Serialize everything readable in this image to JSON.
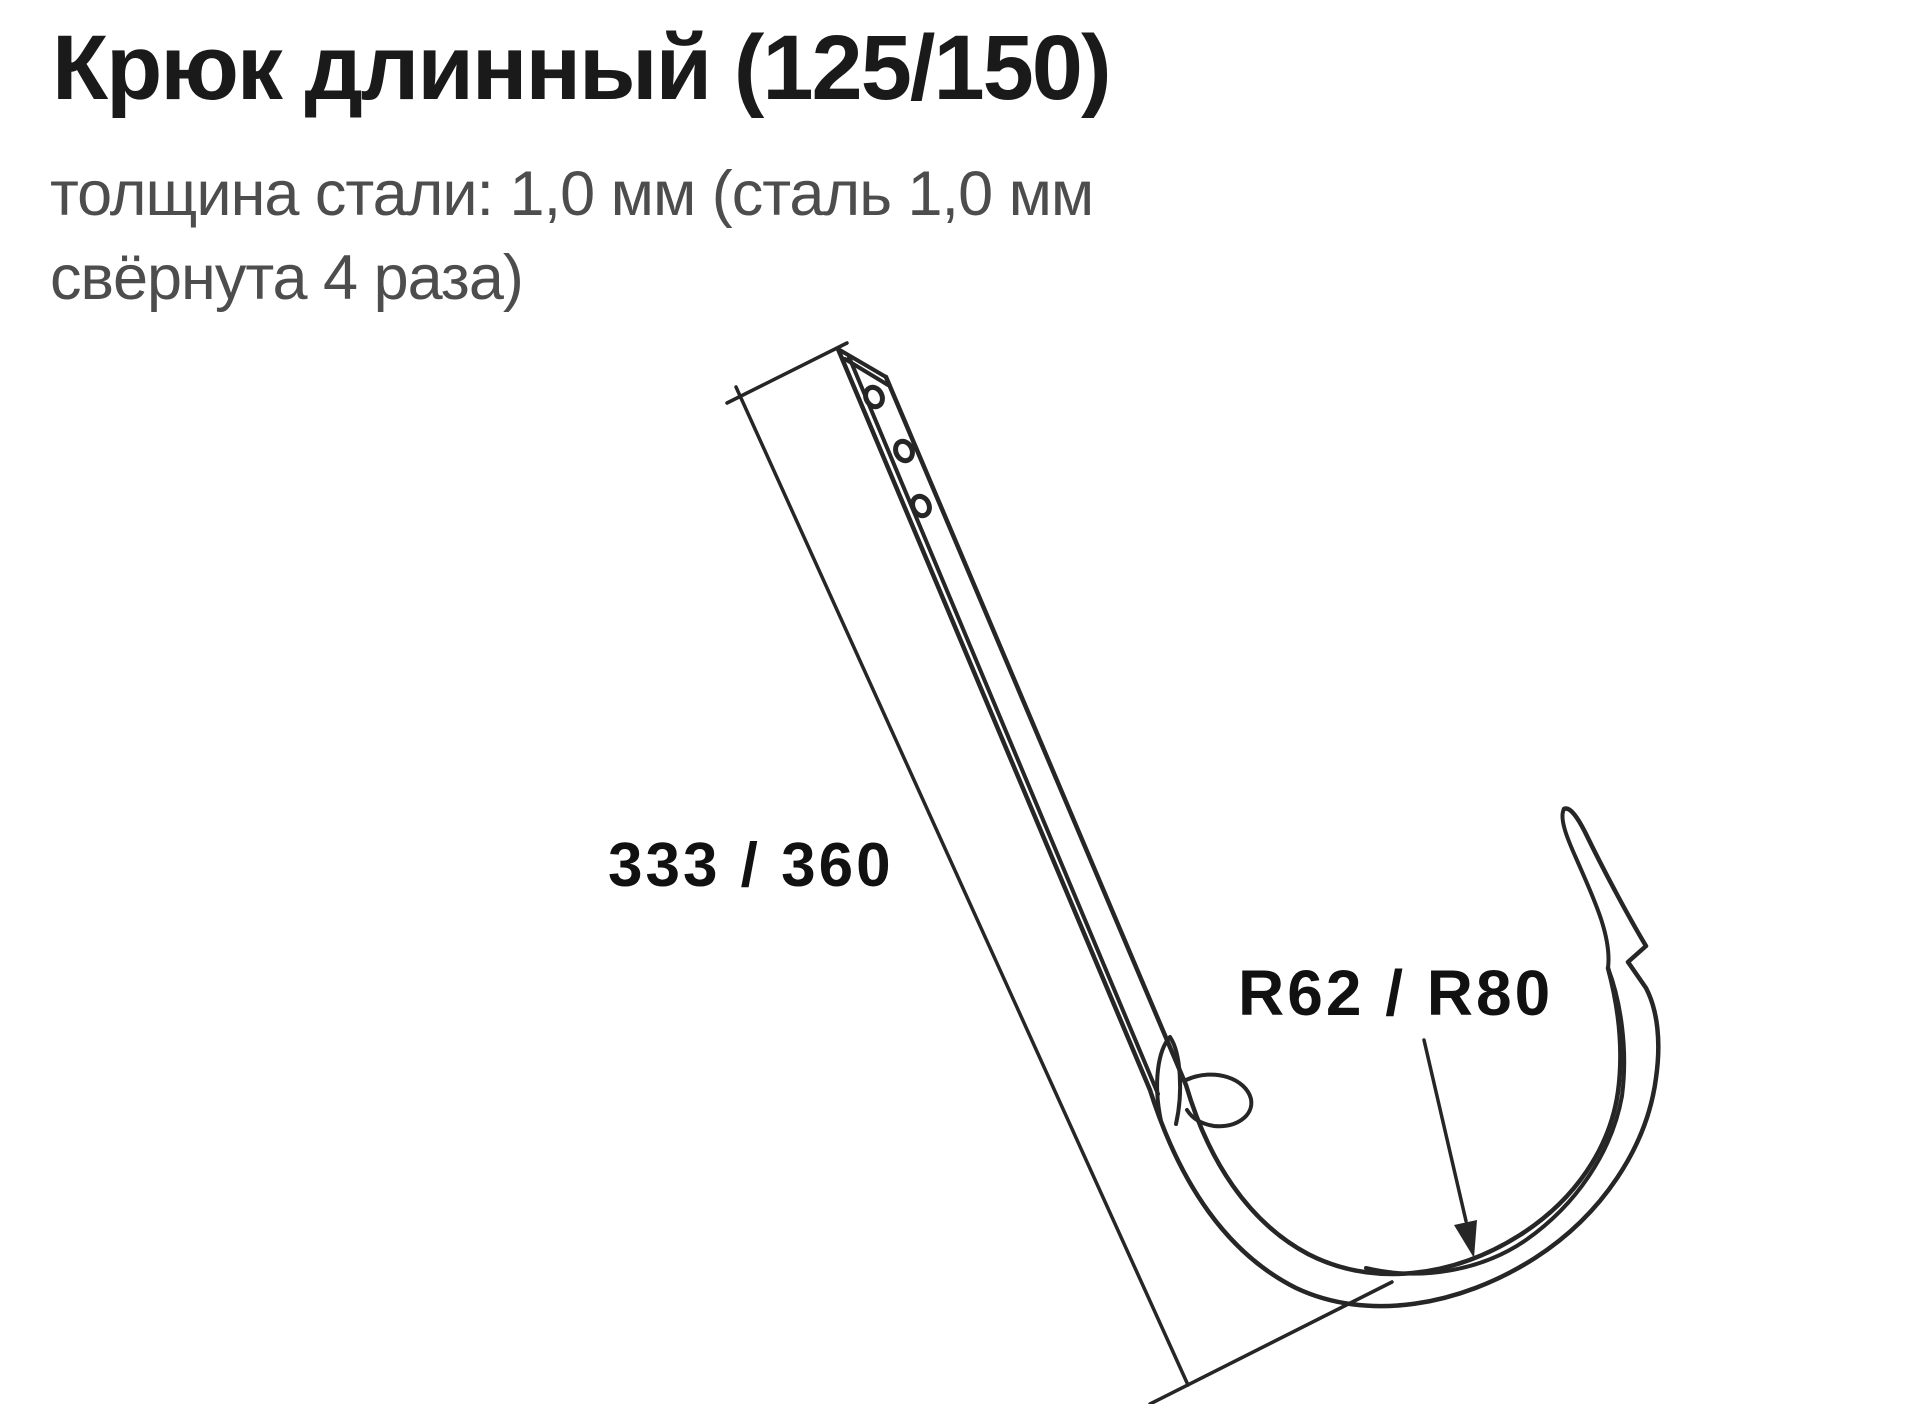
{
  "page": {
    "background_color": "#ffffff"
  },
  "header": {
    "title": "Крюк длинный (125/150)",
    "subtitle_line1": "толщина стали: 1,0 мм (сталь 1,0 мм",
    "subtitle_line2": "свёрнута 4 раза)"
  },
  "diagram": {
    "type": "technical-drawing",
    "part": "gutter-hook-long",
    "length_label": "333 / 360",
    "radius_label": "R62 / R80",
    "hole_count": 3,
    "colors": {
      "line": "#262626",
      "title_text": "#1a1a1a",
      "subtitle_text": "#4d4d4d",
      "label_text": "#111111"
    }
  }
}
